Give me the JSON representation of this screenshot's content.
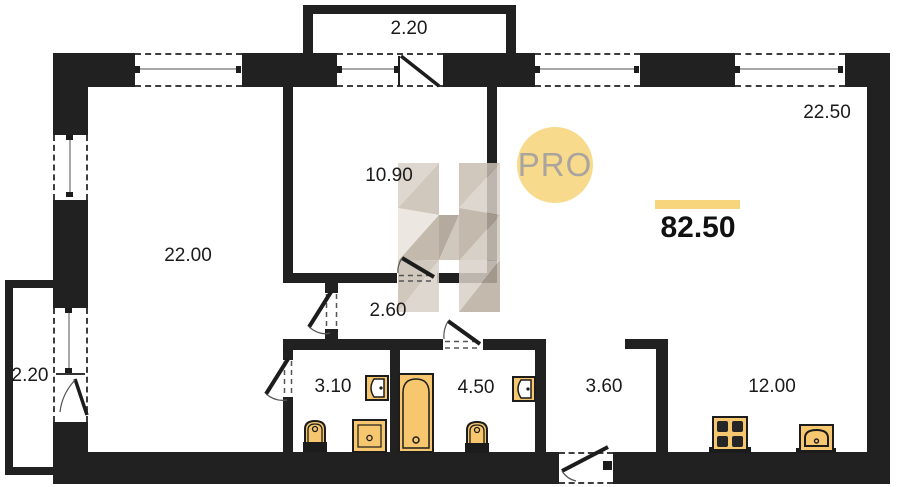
{
  "plan": {
    "kind": "apartment floor plan",
    "logo_text": "PRO",
    "total_area": "82.50"
  },
  "rooms": {
    "balcony_top": {
      "label": "2.20"
    },
    "living": {
      "label": "22.50"
    },
    "room_middle": {
      "label": "10.90"
    },
    "room_left": {
      "label": "22.00"
    },
    "hallway": {
      "label": "2.60"
    },
    "balcony_left": {
      "label": "2.20"
    },
    "bath_small": {
      "label": "3.10"
    },
    "bath_large": {
      "label": "4.50"
    },
    "entry_hall": {
      "label": "3.60"
    },
    "kitchen": {
      "label": "12.00"
    }
  },
  "fixtures": [
    "wall-sink",
    "toilet",
    "shower",
    "bathtub",
    "toilet",
    "wall-sink",
    "stove",
    "kitchen-sink"
  ],
  "colors": {
    "wall": "#212121",
    "fixture_fill": "#f6c76e",
    "fixture_stroke": "#1c1c1c",
    "accent_underline": "#f6d57d",
    "logo_circle": "#f8da8d",
    "logo_text": "#a9a59e",
    "watermark_tint": "#cfc5b8"
  }
}
